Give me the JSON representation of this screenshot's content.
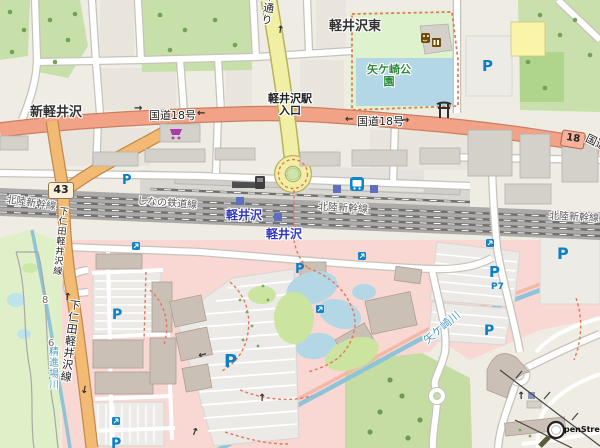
{
  "labels": {
    "place_karuizawa_higashi": "軽井沢東",
    "place_shin_karuizawa": "新軽井沢",
    "road_route18": "国道18号",
    "road_kokudo_partial": "国道",
    "road_badge_18": "18",
    "road_badge_43": "43",
    "station_entrance_l1": "軽井沢駅",
    "station_entrance_l2": "入口",
    "road_hondori": "本通り",
    "road_shimonita": "下仁田軽井沢線",
    "rail_hokuriku": "北陸新幹線",
    "rail_shinano": "しなの鉄道線",
    "station_karuizawa": "軽井沢",
    "park_yagasaki_l1": "矢ケ崎公",
    "park_yagasaki_l2": "園",
    "river_yagasaki": "矢ケ崎川",
    "river_shojinba": "精進場川",
    "parking_p": "P",
    "parking_p7": "P7",
    "golf_hole_8": "8",
    "golf_hole_6": "6",
    "arrow_up": "↑",
    "arrow_down": "↓",
    "arrow_left": "←",
    "arrow_right": "→",
    "attribution_osm": "penStreetMap"
  },
  "colors": {
    "trunk_road": "#F2A286",
    "primary_road": "#F2BA72",
    "secondary_road": "#F1EFA4",
    "retail_area": "#F9D7D3",
    "park_green": "#C7DFA8",
    "golf_green": "#DFF0C8",
    "water": "#B4D7E6",
    "building": "#D4D0CA",
    "rail_track": "#6F6F6F",
    "parking_blue": "#0D7FC4",
    "station_label": "#2F36C0",
    "park_label": "#2E8B3E",
    "water_label": "#4D9DC0",
    "footpath_red": "#E8735C"
  }
}
